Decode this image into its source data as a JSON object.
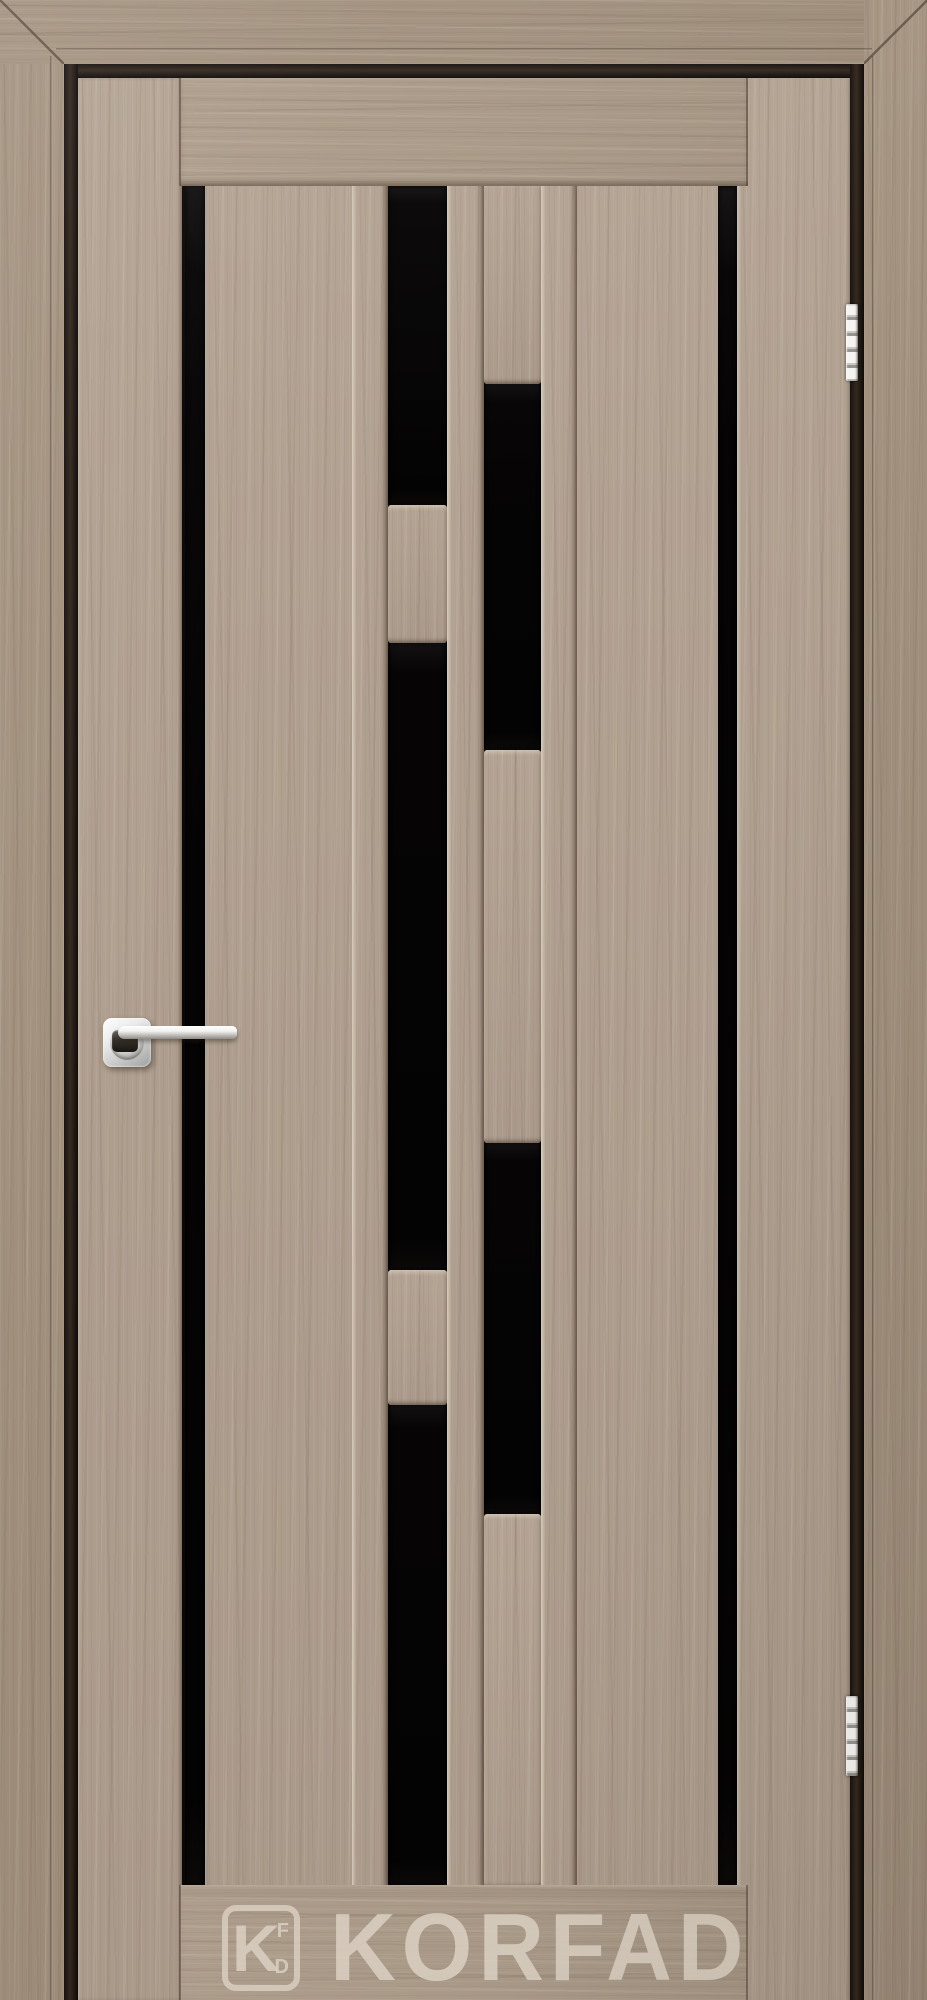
{
  "photo": {
    "subject": "interior wood door with staggered black glass strip inserts, grey-oak laminate finish, shown installed in matching casing frame",
    "brand": "KORFAD"
  },
  "watermark": {
    "text": "KORFAD",
    "logo": {
      "main_letter": "K",
      "top_letter": "F",
      "bottom_letter": "D"
    },
    "color": "#d9cfc1"
  },
  "palette": {
    "wood_base": "#b1a090",
    "wood_casing": "#a3917e",
    "wood_light_streak": "#cfc1af",
    "wood_dark_streak": "#8c7b6a",
    "glass_black": "#070505",
    "gap_shadow": "#211a14",
    "chrome": "#efefed"
  },
  "hardware": {
    "handle": {
      "type": "lever handle on square rosette",
      "finish": "polished chrome"
    },
    "hinges": {
      "count": 2,
      "finish": "polished chrome"
    }
  }
}
